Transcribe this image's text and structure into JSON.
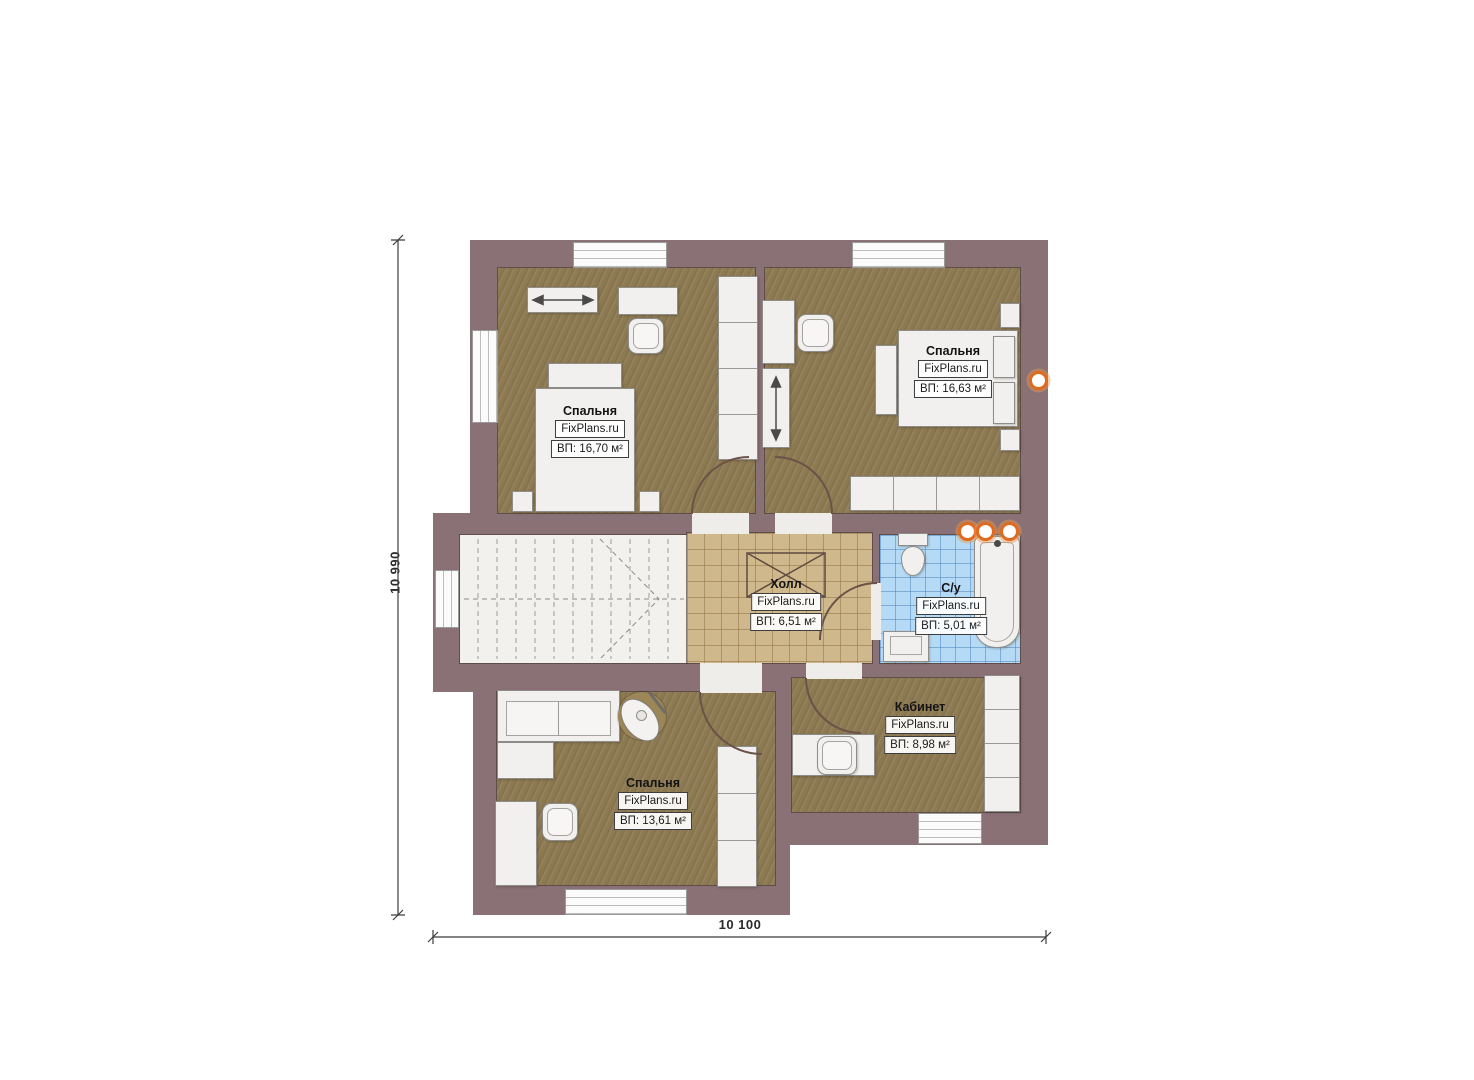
{
  "brand": "FixPlans.ru",
  "dimensions": {
    "vertical": "10 990",
    "horizontal": "10 100"
  },
  "rooms": [
    {
      "key": "bedroom-top-left",
      "name": "Спальня",
      "area": "ВП: 16,70 м²"
    },
    {
      "key": "bedroom-top-right",
      "name": "Спальня",
      "area": "ВП: 16,63 м²"
    },
    {
      "key": "hall",
      "name": "Холл",
      "area": "ВП: 6,51 м²"
    },
    {
      "key": "bathroom",
      "name": "С/у",
      "area": "ВП: 5,01 м²"
    },
    {
      "key": "bedroom-bottom",
      "name": "Спальня",
      "area": "ВП: 13,61 м²"
    },
    {
      "key": "office",
      "name": "Кабинет",
      "area": "ВП: 8,98 м²"
    }
  ],
  "colors": {
    "wall": "#8a7176",
    "wood_floor": "#8d7a52",
    "hall_floor": "#cfb98c",
    "bath_floor": "#b5daf5",
    "accent_orange": "#e06a1e"
  }
}
